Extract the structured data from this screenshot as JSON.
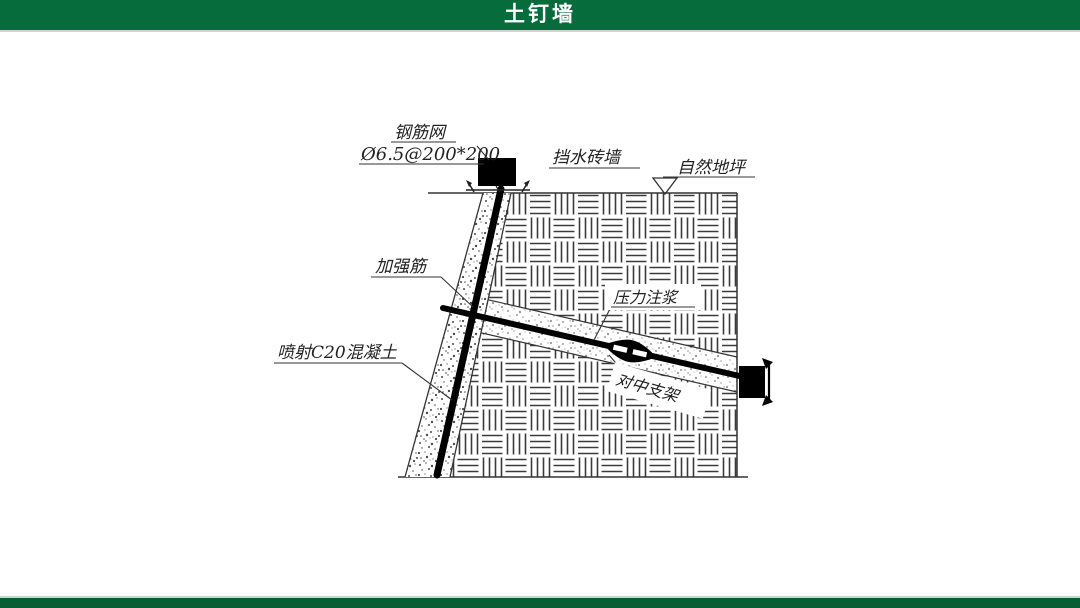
{
  "header": {
    "title": "土钉墙",
    "bar_color": "#066c3b",
    "text_color": "#ffffff"
  },
  "footer": {
    "bar_color": "#085e33"
  },
  "diagram": {
    "type": "technical-section-drawing",
    "subject": "soil nail wall construction detail",
    "labels": {
      "steel_mesh": "钢筋网",
      "steel_mesh_spec": "Ø6.5@200*200",
      "brick_wall": "挡水砖墙",
      "natural_ground": "自然地坪",
      "reinforcement_rib": "加强筋",
      "pressure_grouting": "压力注浆",
      "shotcrete": "喷射C20混凝土",
      "centering_bracket": "对中支架"
    },
    "colors": {
      "line": "#333333",
      "bar": "#000000",
      "hatch": "#3b3b3b",
      "background": "#ffffff"
    }
  }
}
